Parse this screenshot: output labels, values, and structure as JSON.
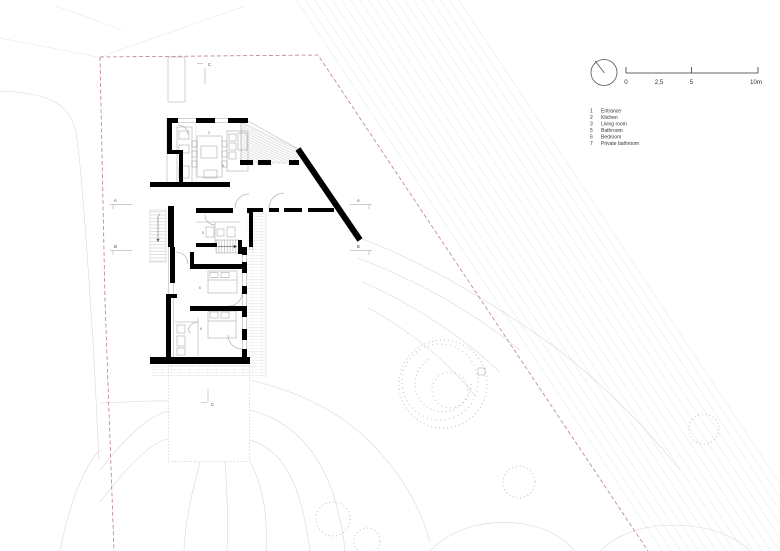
{
  "drawing": {
    "type": "architectural-site-floor-plan",
    "scale_bar": {
      "t0": "0",
      "t25": "2,5",
      "t5": "5",
      "t10": "10m"
    },
    "legend": {
      "items": [
        {
          "num": "1",
          "label": "Entrance"
        },
        {
          "num": "2",
          "label": "Kitchen"
        },
        {
          "num": "3",
          "label": "Living room"
        },
        {
          "num": "5",
          "label": "Bathroom"
        },
        {
          "num": "6",
          "label": "Bedroom"
        },
        {
          "num": "7",
          "label": "Private bathroom"
        }
      ]
    },
    "section_markers": {
      "a": "A",
      "b": "B",
      "c": "C"
    },
    "room_numbers": {
      "entrance": "1",
      "kitchen": "2",
      "living": "3",
      "bathroom": "5",
      "bedroom1": "6",
      "bedroom2": "6",
      "private_bathroom": "7"
    },
    "colors": {
      "boundary": "#bf7f7f",
      "wall": "#000000",
      "contour": "#d8d8d8",
      "furniture": "#9a9a9a"
    }
  }
}
